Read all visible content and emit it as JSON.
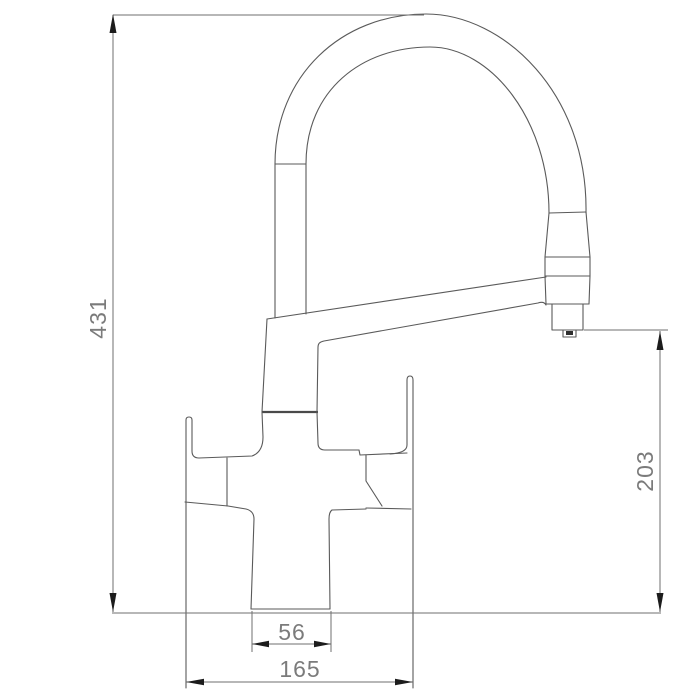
{
  "drawing": {
    "object": "faucet-technical-drawing",
    "dimension_labels": {
      "overall_height": "431",
      "spout_outlet_height": "203",
      "base_width": "56",
      "overall_width": "165"
    },
    "colors": {
      "background": "#ffffff",
      "outline": "#5a5a5a",
      "dimension_line": "#6f6f6f",
      "arrowhead": "#1c1c1c",
      "label_text": "#7b7b7b"
    }
  }
}
